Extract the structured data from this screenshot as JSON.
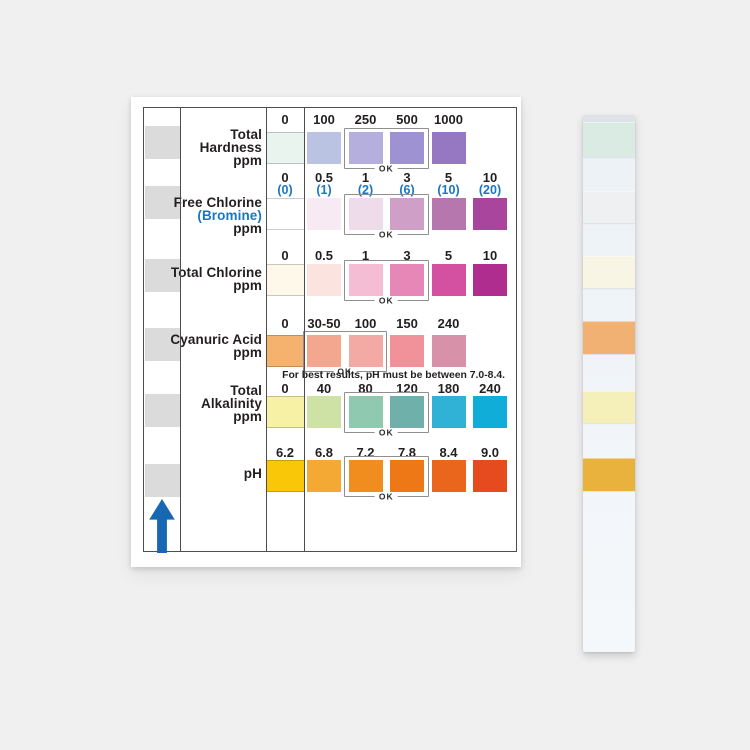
{
  "colors": {
    "accent_blue": "#1b76bf",
    "arrow_blue": "#1668b2",
    "guide_pad": "#dbdbdb",
    "ok_border": "#8f8f8f"
  },
  "card": {
    "ok_label": "OK",
    "note": "For best results, pH must be between 7.0-8.4.",
    "rows": [
      {
        "id": "total-hardness",
        "label_lines": [
          "Total",
          "Hardness",
          "ppm"
        ],
        "accent_line": -1,
        "zero_value": "0",
        "zero_sub": "",
        "zero_color": "#e9f4ef",
        "values": [
          "100",
          "250",
          "500",
          "1000"
        ],
        "subvalues": [],
        "swatch_colors": [
          "#bac4e2",
          "#b4afdd",
          "#9f92d2",
          "#9577c2"
        ],
        "ok_start": 1,
        "ok_span": 2
      },
      {
        "id": "free-chlorine",
        "label_lines": [
          "Free Chlorine",
          "(Bromine)",
          "ppm"
        ],
        "accent_line": 1,
        "zero_value": "0",
        "zero_sub": "(0)",
        "zero_color": "#ffffff",
        "values": [
          "0.5",
          "1",
          "3",
          "5",
          "10"
        ],
        "subvalues": [
          "(1)",
          "(2)",
          "(6)",
          "(10)",
          "(20)"
        ],
        "swatch_colors": [
          "#f7eaf3",
          "#eedcea",
          "#d09fc8",
          "#b577ae",
          "#a9459d"
        ],
        "ok_start": 1,
        "ok_span": 2
      },
      {
        "id": "total-chlorine",
        "label_lines": [
          "Total Chlorine",
          "ppm"
        ],
        "accent_line": -1,
        "zero_value": "0",
        "zero_sub": "",
        "zero_color": "#fdf8ea",
        "values": [
          "0.5",
          "1",
          "3",
          "5",
          "10"
        ],
        "subvalues": [],
        "swatch_colors": [
          "#fbe3df",
          "#f5bdd3",
          "#e687b7",
          "#d351a0",
          "#b02d90"
        ],
        "ok_start": 1,
        "ok_span": 2
      },
      {
        "id": "cyanuric-acid",
        "label_lines": [
          "Cyanuric Acid",
          "ppm"
        ],
        "accent_line": -1,
        "zero_value": "0",
        "zero_sub": "",
        "zero_color": "#f5b16e",
        "values": [
          "30-50",
          "100",
          "150",
          "240"
        ],
        "subvalues": [],
        "swatch_colors": [
          "#f3a78f",
          "#f4aaa4",
          "#f19199",
          "#d791a8"
        ],
        "ok_start": 0,
        "ok_span": 2
      },
      {
        "id": "total-alkalinity",
        "label_lines": [
          "Total",
          "Alkalinity",
          "ppm"
        ],
        "accent_line": -1,
        "zero_value": "0",
        "zero_sub": "",
        "zero_color": "#f7f1a5",
        "values": [
          "40",
          "80",
          "120",
          "180",
          "240"
        ],
        "subvalues": [],
        "swatch_colors": [
          "#cee2a5",
          "#8fcab0",
          "#6fb0aa",
          "#2fb2d6",
          "#10add9"
        ],
        "ok_start": 1,
        "ok_span": 2
      },
      {
        "id": "ph",
        "label_lines": [
          "pH"
        ],
        "accent_line": -1,
        "zero_value": "6.2",
        "zero_sub": "",
        "zero_color": "#fac608",
        "values": [
          "6.8",
          "7.2",
          "7.8",
          "8.4",
          "9.0"
        ],
        "subvalues": [],
        "swatch_colors": [
          "#f5a935",
          "#f18d1f",
          "#ee7716",
          "#ea661d",
          "#e54b1e"
        ],
        "ok_start": 1,
        "ok_span": 2
      }
    ]
  },
  "strip": {
    "pads": [
      {
        "id": "total-hardness",
        "color": "#d9ebe3"
      },
      {
        "id": "free-chlorine",
        "color": "#eef0f2"
      },
      {
        "id": "total-chlorine",
        "color": "#f9f5e4"
      },
      {
        "id": "cyanuric-acid",
        "color": "#f1b173"
      },
      {
        "id": "total-alkalinity",
        "color": "#f5f0ba"
      },
      {
        "id": "ph",
        "color": "#e8b23c"
      }
    ]
  }
}
